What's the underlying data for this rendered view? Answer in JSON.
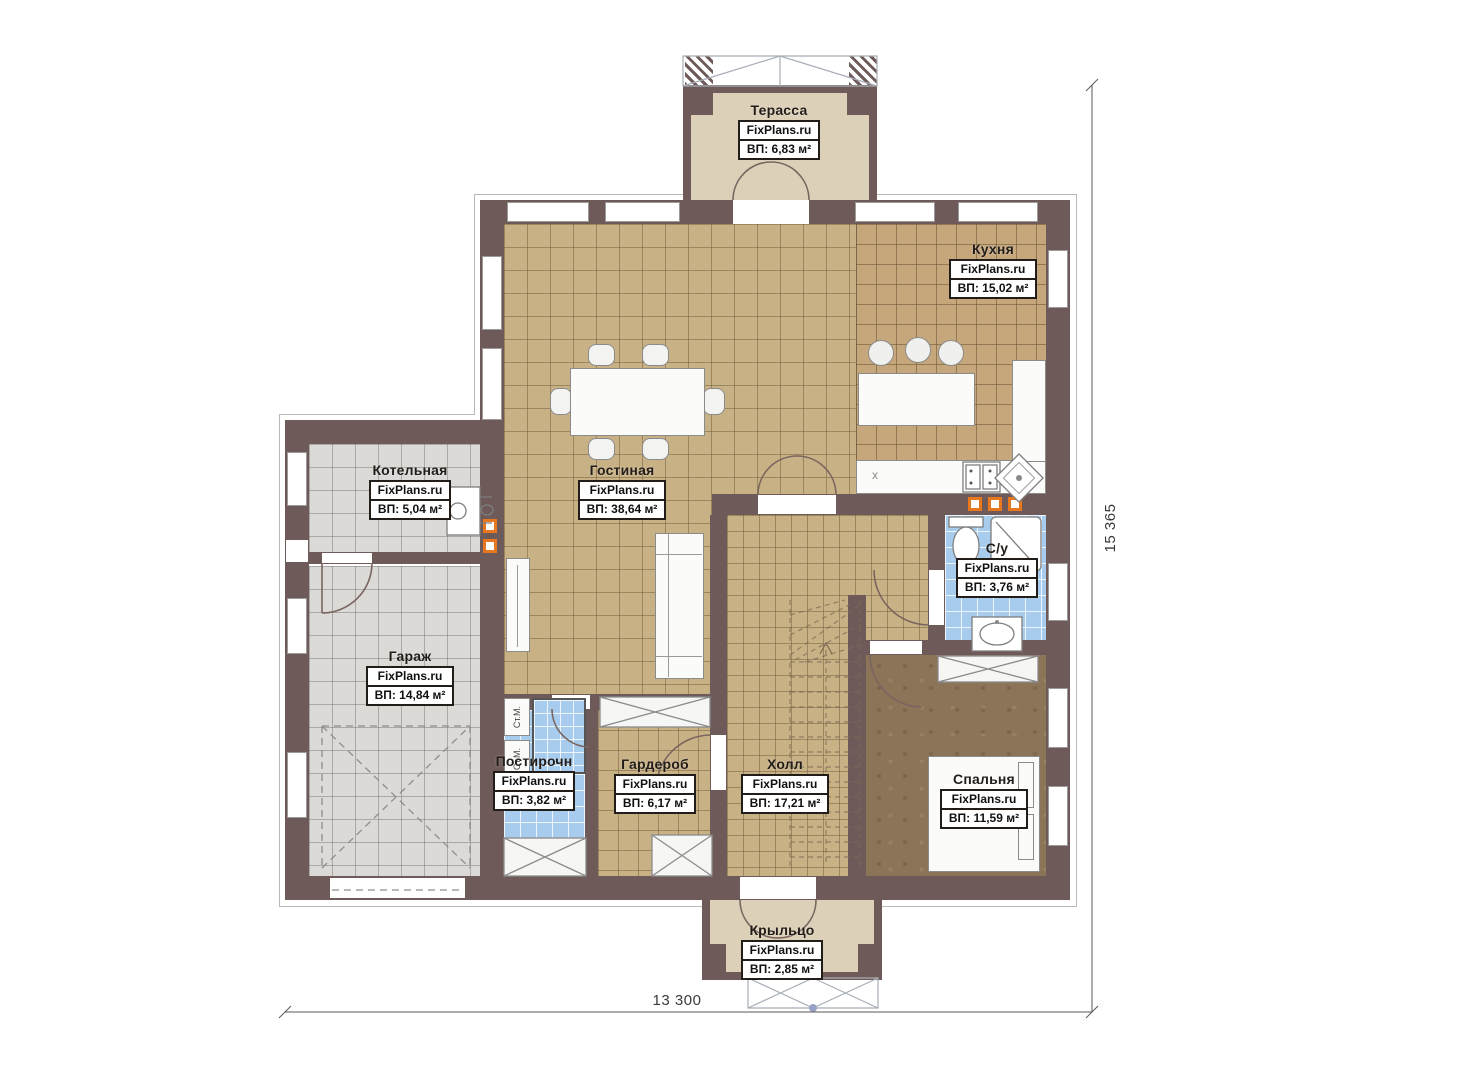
{
  "plan": {
    "brand": "FixPlans.ru",
    "rooms": [
      {
        "key": "terrace",
        "name": "Терасса",
        "area": "ВП: 6,83 м²"
      },
      {
        "key": "kitchen",
        "name": "Кухня",
        "area": "ВП: 15,02 м²"
      },
      {
        "key": "boiler",
        "name": "Котельная",
        "area": "ВП: 5,04 м²"
      },
      {
        "key": "living",
        "name": "Гостиная",
        "area": "ВП: 38,64 м²"
      },
      {
        "key": "bathroom",
        "name": "С/у",
        "area": "ВП: 3,76 м²"
      },
      {
        "key": "garage",
        "name": "Гараж",
        "area": "ВП: 14,84 м²"
      },
      {
        "key": "laundry",
        "name": "Постирочн",
        "area": "ВП: 3,82 м²"
      },
      {
        "key": "wardrobe",
        "name": "Гардероб",
        "area": "ВП: 6,17 м²"
      },
      {
        "key": "hall",
        "name": "Холл",
        "area": "ВП: 17,21 м²"
      },
      {
        "key": "bedroom",
        "name": "Спальня",
        "area": "ВП: 11,59 м²"
      },
      {
        "key": "porch",
        "name": "Крыльцо",
        "area": "ВП: 2,85 м²"
      }
    ],
    "dimensions": {
      "bottom": "13 300",
      "right": "15 365"
    },
    "annotations": {
      "washing_machine": "Ст.М.",
      "appliance_mark": "х"
    },
    "colors": {
      "wall": "#6e5b59",
      "floor_tan": "#c8b185",
      "floor_kitchen": "#c6a77c",
      "floor_gray": "#dbdad7",
      "floor_blue": "#a7ccee",
      "floor_bedroom": "#8c7459",
      "floor_beige": "#ddd0b8",
      "socket": "#e8781e"
    }
  }
}
